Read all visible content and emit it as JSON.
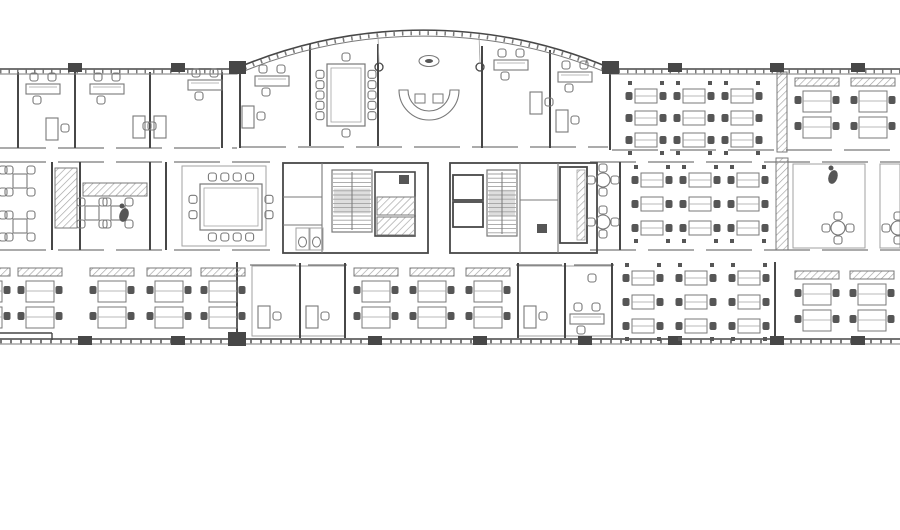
{
  "meta": {
    "drawing_type": "office-floor-plan"
  },
  "canvas": {
    "w": 900,
    "h": 530,
    "bg": "#ffffff"
  },
  "palette": {
    "wall": "#3a3a3a",
    "line": "#6f6f6f",
    "light": "#9b9b9b",
    "dark": "#4a4a4a",
    "landing": "#dcdcdc"
  },
  "plan": {
    "exterior": {
      "arc": {
        "x1": 237,
        "x2": 610,
        "y": 70,
        "r": 478
      },
      "topWalls": [
        [
          0,
          237
        ],
        [
          610,
          900
        ]
      ],
      "topY": 70,
      "bottomY": 340,
      "cornerBlocks": [
        [
          229,
          61,
          17,
          13
        ],
        [
          602,
          61,
          17,
          13
        ],
        [
          228,
          332,
          18,
          14
        ]
      ],
      "columnsTop": [
        75,
        178,
        675,
        777,
        858
      ],
      "columnsBottom": [
        85,
        178,
        375,
        480,
        585,
        675,
        777,
        858
      ],
      "steps": [
        [
          0,
          333,
          52,
          333
        ],
        [
          52,
          333,
          52,
          340
        ]
      ]
    },
    "walls": [
      [
        18,
        72,
        18,
        148
      ],
      [
        75,
        72,
        75,
        148
      ],
      [
        150,
        72,
        150,
        148
      ],
      [
        222,
        72,
        222,
        148
      ],
      [
        240,
        70,
        240,
        148
      ],
      [
        310,
        44,
        310,
        146
      ],
      [
        378,
        44,
        378,
        146
      ],
      [
        482,
        46,
        482,
        148
      ],
      [
        550,
        50,
        550,
        148
      ],
      [
        610,
        70,
        610,
        150
      ],
      [
        52,
        162,
        52,
        250
      ],
      [
        80,
        162,
        80,
        250
      ],
      [
        150,
        162,
        150,
        250
      ],
      [
        166,
        162,
        166,
        250
      ],
      [
        620,
        162,
        620,
        250
      ],
      [
        237,
        262,
        237,
        340
      ],
      [
        300,
        263,
        300,
        338
      ],
      [
        345,
        263,
        345,
        338
      ],
      [
        518,
        263,
        518,
        338
      ],
      [
        565,
        263,
        565,
        338
      ],
      [
        612,
        263,
        612,
        338
      ],
      [
        775,
        262,
        775,
        340
      ]
    ],
    "corridors": [
      [
        0,
        148,
        237,
        148
      ],
      [
        240,
        147,
        608,
        147
      ],
      [
        612,
        150,
        900,
        150
      ],
      [
        0,
        162,
        270,
        162
      ],
      [
        590,
        162,
        900,
        162
      ],
      [
        0,
        250,
        270,
        250
      ],
      [
        590,
        250,
        900,
        250
      ],
      [
        250,
        265,
        347,
        265
      ],
      [
        516,
        265,
        614,
        265
      ]
    ],
    "rooms": [
      [
        182,
        166,
        84,
        80
      ],
      [
        252,
        266,
        48,
        70
      ],
      [
        300,
        266,
        45,
        70
      ],
      [
        518,
        266,
        47,
        70
      ],
      [
        565,
        266,
        47,
        70
      ],
      [
        793,
        164,
        72,
        84
      ],
      [
        880,
        164,
        20,
        84
      ]
    ],
    "core": {
      "outer": [
        [
          283,
          163,
          145,
          90
        ],
        [
          450,
          163,
          147,
          90
        ]
      ],
      "innerLines": [
        [
          322,
          163,
          322,
          253
        ],
        [
          283,
          197,
          322,
          197
        ],
        [
          283,
          225,
          322,
          225
        ],
        [
          520,
          163,
          520,
          253
        ],
        [
          520,
          200,
          558,
          200
        ],
        [
          558,
          163,
          558,
          253
        ]
      ],
      "stairs": [
        [
          332,
          170,
          40,
          62
        ],
        [
          487,
          170,
          30,
          66
        ]
      ],
      "elevShaft": [
        375,
        172,
        40,
        64
      ],
      "elevHatched": [
        [
          377,
          197,
          38,
          18
        ],
        [
          377,
          217,
          38,
          18
        ]
      ],
      "elevOpen": [
        [
          453,
          175,
          30,
          25
        ],
        [
          453,
          202,
          30,
          25
        ]
      ],
      "shaftRight": [
        560,
        167,
        27,
        76
      ],
      "shaftRightHatch": [
        577,
        170,
        8,
        70
      ],
      "wcs": [
        [
          296,
          228
        ],
        [
          310,
          228
        ]
      ],
      "darkSquares": [
        [
          399,
          175
        ],
        [
          537,
          224
        ]
      ]
    },
    "hatches": [
      [
        55,
        168,
        22,
        60
      ],
      [
        83,
        183,
        64,
        13
      ],
      [
        777,
        72,
        10,
        80
      ],
      [
        776,
        158,
        12,
        92
      ]
    ],
    "furniture": {
      "desksets": [
        [
          26,
          84
        ],
        [
          90,
          84
        ],
        [
          188,
          80
        ],
        [
          255,
          76
        ],
        [
          494,
          60
        ],
        [
          558,
          72
        ],
        [
          570,
          314
        ]
      ],
      "smalldesks": [
        [
          46,
          118,
          0
        ],
        [
          133,
          116,
          0
        ],
        [
          154,
          116,
          1
        ],
        [
          242,
          106,
          0
        ],
        [
          530,
          92,
          0
        ],
        [
          556,
          110,
          0
        ],
        [
          258,
          306,
          0
        ],
        [
          306,
          306,
          0
        ],
        [
          524,
          306,
          0
        ]
      ],
      "pods": [
        [
          -34,
          268
        ],
        [
          18,
          268
        ],
        [
          90,
          268
        ],
        [
          147,
          268
        ],
        [
          201,
          268
        ],
        [
          354,
          268
        ],
        [
          410,
          268
        ],
        [
          466,
          268
        ],
        [
          795,
          78
        ],
        [
          851,
          78
        ],
        [
          795,
          271
        ],
        [
          850,
          271
        ]
      ],
      "grids": [
        {
          "cx0": 646,
          "cy0": 96,
          "dx": 48,
          "dy": 22,
          "cols": 3,
          "rows": 3
        },
        {
          "cx0": 652,
          "cy0": 180,
          "dx": 48,
          "dy": 24,
          "cols": 3,
          "rows": 3
        },
        {
          "cx0": 643,
          "cy0": 278,
          "dx": 53,
          "dy": 24,
          "cols": 3,
          "rows": 3
        }
      ],
      "confs": [
        {
          "x": 327,
          "y": 64,
          "w": 38,
          "h": 62,
          "top": 1,
          "bottom": 1,
          "left": 5,
          "right": 5
        },
        {
          "x": 200,
          "y": 184,
          "w": 62,
          "h": 46,
          "top": 4,
          "bottom": 4,
          "left": 2,
          "right": 2
        }
      ],
      "sq4": [
        [
          -8,
          181
        ],
        [
          20,
          181
        ],
        [
          -8,
          226
        ],
        [
          20,
          226
        ],
        [
          92,
          213
        ],
        [
          118,
          213
        ]
      ],
      "round4": [
        [
          603,
          180
        ],
        [
          603,
          222
        ],
        [
          838,
          228
        ],
        [
          898,
          228
        ]
      ],
      "reception": {
        "table": [
          429,
          61
        ],
        "sofa": [
          429,
          90
        ]
      },
      "roundColumns": [
        [
          379,
          67
        ],
        [
          480,
          67
        ]
      ],
      "blobs": [
        [
          833,
          177
        ],
        [
          124,
          215
        ]
      ],
      "singleChairs": [
        [
          592,
          278
        ]
      ]
    }
  }
}
